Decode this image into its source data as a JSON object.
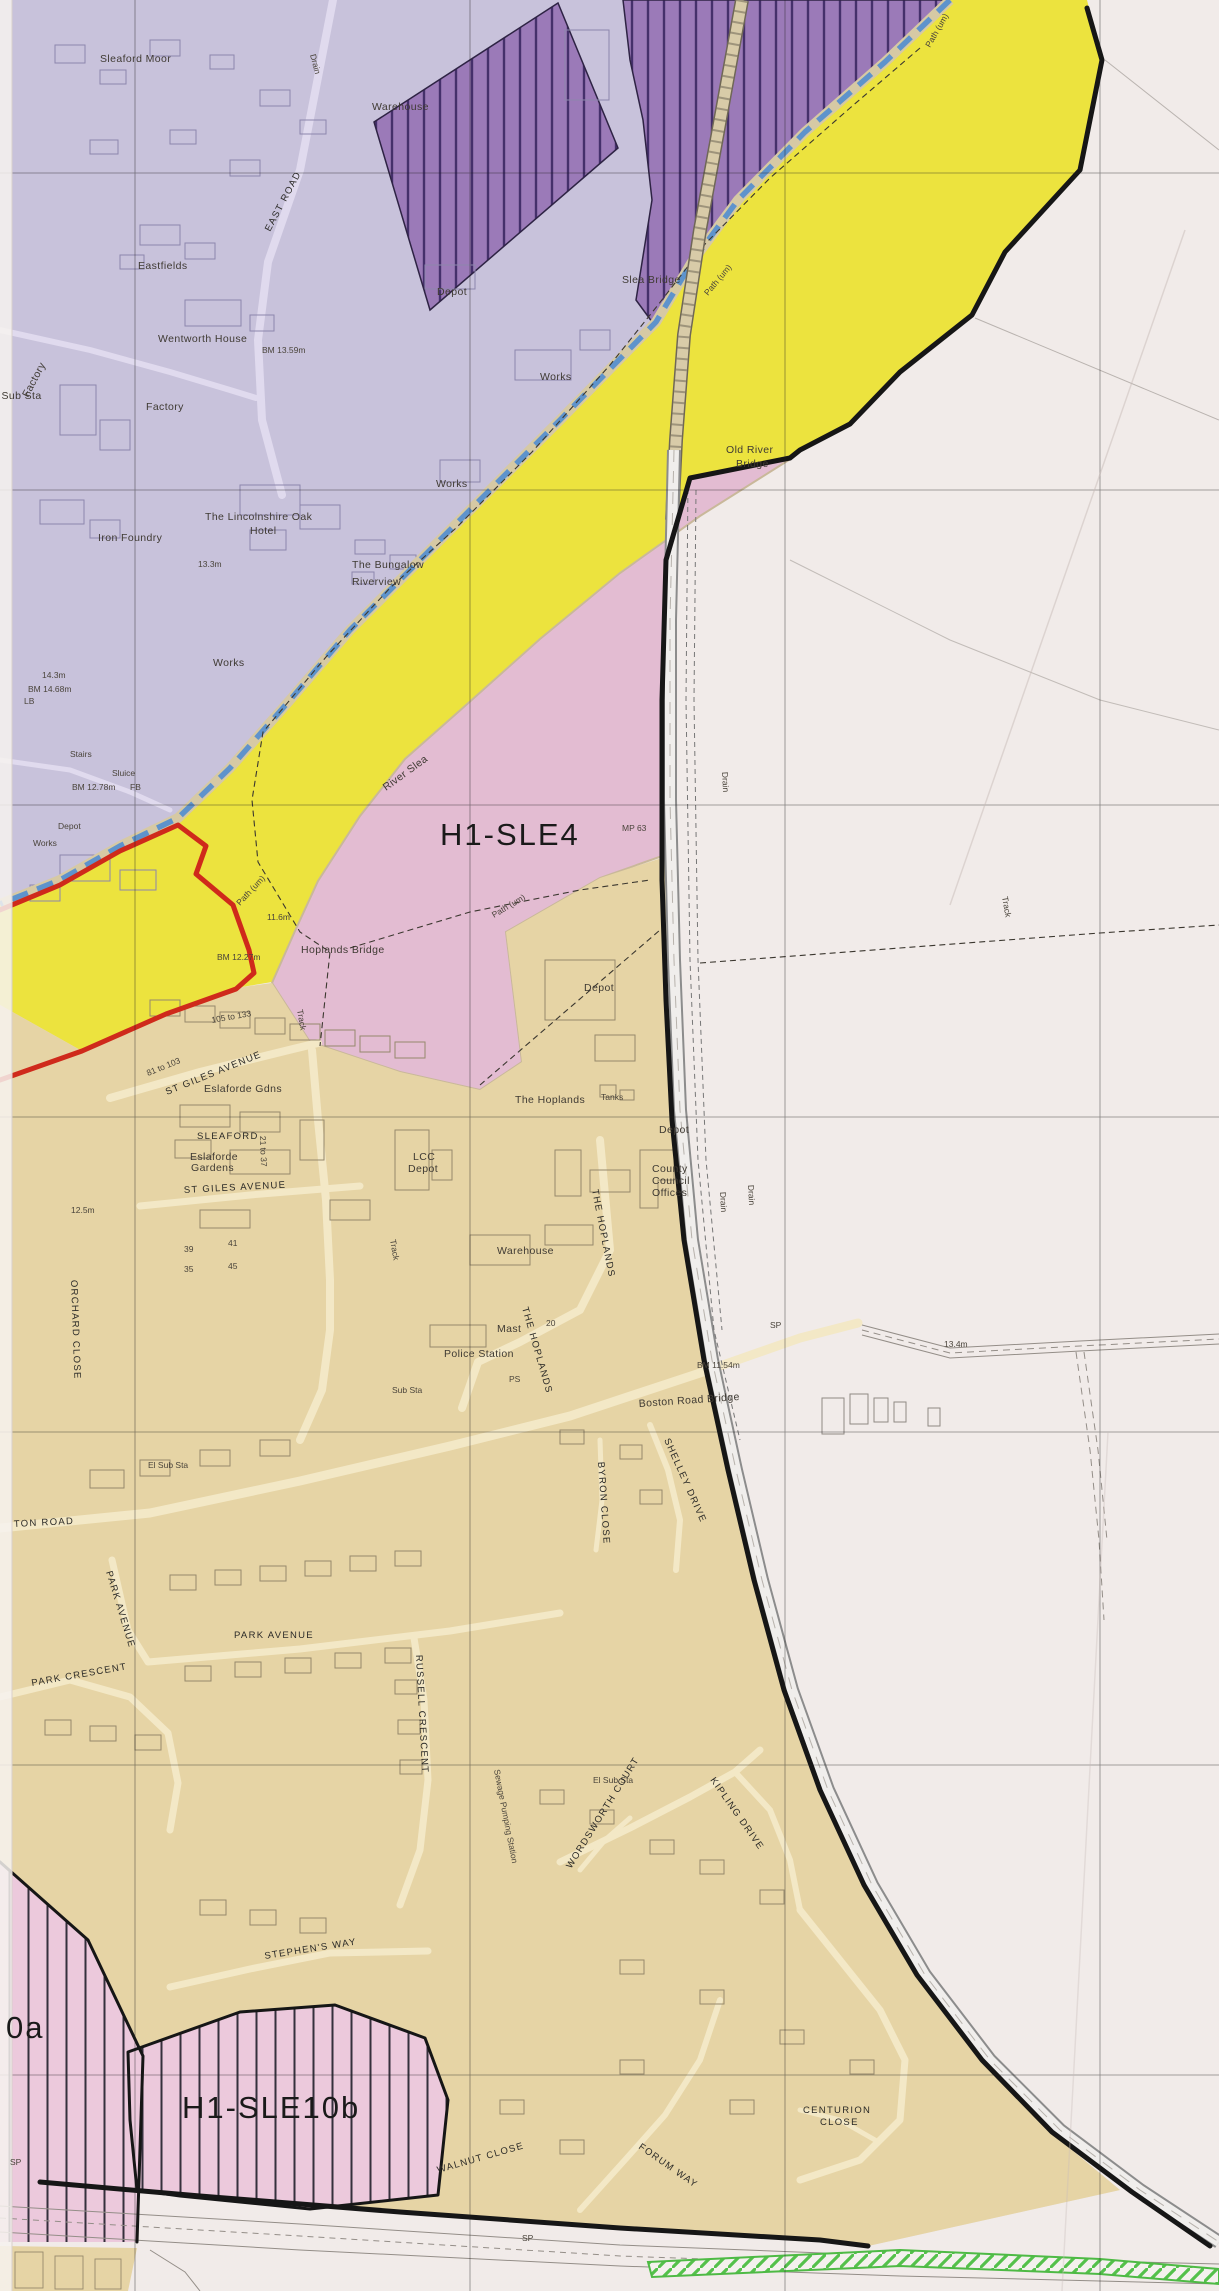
{
  "map": {
    "title": "Local plan proposals map extract (scanned)",
    "zones": [
      {
        "code": "H1-SLE4",
        "fill": "#e3bcd2",
        "style": "solid pink housing allocation"
      },
      {
        "code": "H1-SLE10b",
        "fill": "#ecc9dc",
        "style": "pink vertical-hatched housing allocation"
      },
      {
        "code": "0a",
        "fill": "#ecc9dc",
        "style": "pink vertical-hatched allocation clipped at map edge"
      }
    ],
    "colors": {
      "paper": "#f1ebe9",
      "urban_lavender": "#c8c2db",
      "allocation_purple": "#9b7ab8",
      "purple_hatch_line": "#45306b",
      "river_corridor_yellow": "#ece33e",
      "housing_pink": "#e3bcd2",
      "hatched_pink": "#ecc9dc",
      "residential_beige": "#e6d4a5",
      "river_blue": "#5e93cc",
      "boundary_black": "#161616",
      "boundary_red": "#cf2a1b",
      "railway_buff": "#d8cba8",
      "green_hatch": "#4eba45"
    },
    "labels": [
      {
        "t": "H1-SLE4",
        "x": 440,
        "y": 845,
        "c": "zone"
      },
      {
        "t": "H1-SLE10b",
        "x": 182,
        "y": 2118,
        "c": "zone"
      },
      {
        "t": "0a",
        "x": 6,
        "y": 2038,
        "c": "zone"
      },
      {
        "t": "Sleaford Moor",
        "x": 100,
        "y": 62,
        "c": "place"
      },
      {
        "t": "Warehouse",
        "x": 372,
        "y": 110,
        "c": "place"
      },
      {
        "t": "Eastfields",
        "x": 138,
        "y": 269,
        "c": "place"
      },
      {
        "t": "Wentworth House",
        "x": 158,
        "y": 342,
        "c": "place"
      },
      {
        "t": "Factory",
        "x": 28,
        "y": 398,
        "r": -62,
        "c": "place"
      },
      {
        "t": "Factory",
        "x": 146,
        "y": 410,
        "c": "place"
      },
      {
        "t": "El Sub Sta",
        "x": -12,
        "y": 399,
        "c": "place"
      },
      {
        "t": "Depot",
        "x": 437,
        "y": 295,
        "c": "place"
      },
      {
        "t": "BM 13.59m",
        "x": 262,
        "y": 353,
        "c": "small"
      },
      {
        "t": "Works",
        "x": 540,
        "y": 380,
        "c": "place"
      },
      {
        "t": "Works",
        "x": 436,
        "y": 487,
        "c": "place"
      },
      {
        "t": "Works",
        "x": 213,
        "y": 666,
        "c": "place"
      },
      {
        "t": "Stairs",
        "x": 70,
        "y": 757,
        "c": "small"
      },
      {
        "t": "Depot",
        "x": 58,
        "y": 829,
        "c": "small"
      },
      {
        "t": "Works",
        "x": 33,
        "y": 846,
        "c": "small"
      },
      {
        "t": "14.3m",
        "x": 42,
        "y": 678,
        "c": "small"
      },
      {
        "t": "BM 14.68m",
        "x": 28,
        "y": 692,
        "c": "small"
      },
      {
        "t": "LB",
        "x": 24,
        "y": 704,
        "c": "small"
      },
      {
        "t": "BM 12.78m",
        "x": 72,
        "y": 790,
        "c": "small"
      },
      {
        "t": "Sluice",
        "x": 112,
        "y": 776,
        "c": "small"
      },
      {
        "t": "FB",
        "x": 130,
        "y": 790,
        "c": "small"
      },
      {
        "t": "Iron Foundry",
        "x": 98,
        "y": 541,
        "c": "place"
      },
      {
        "t": "The Lincolnshire Oak",
        "x": 205,
        "y": 520,
        "c": "place"
      },
      {
        "t": "Hotel",
        "x": 250,
        "y": 534,
        "c": "place"
      },
      {
        "t": "13.3m",
        "x": 198,
        "y": 567,
        "c": "small"
      },
      {
        "t": "The Bungalow",
        "x": 352,
        "y": 568,
        "c": "place"
      },
      {
        "t": "Riverview",
        "x": 352,
        "y": 585,
        "c": "place"
      },
      {
        "t": "Slea Bridge",
        "x": 622,
        "y": 283,
        "c": "place"
      },
      {
        "t": "Old River",
        "x": 726,
        "y": 453,
        "c": "place"
      },
      {
        "t": "Bridge",
        "x": 736,
        "y": 467,
        "c": "place"
      },
      {
        "t": "River Slea",
        "x": 386,
        "y": 791,
        "r": -36,
        "c": "place"
      },
      {
        "t": "EAST ROAD",
        "x": 270,
        "y": 232,
        "r": -62,
        "c": "street"
      },
      {
        "t": "Drain",
        "x": 310,
        "y": 55,
        "r": 75,
        "c": "small"
      },
      {
        "t": "Path (um)",
        "x": 930,
        "y": 48,
        "r": -60,
        "c": "small"
      },
      {
        "t": "Path (um)",
        "x": 708,
        "y": 296,
        "r": -50,
        "c": "small"
      },
      {
        "t": "Path (um)",
        "x": 240,
        "y": 906,
        "r": -47,
        "c": "small"
      },
      {
        "t": "Path (um)",
        "x": 494,
        "y": 918,
        "r": -31,
        "c": "small"
      },
      {
        "t": "MP 63",
        "x": 622,
        "y": 831,
        "c": "small"
      },
      {
        "t": "Drain",
        "x": 722,
        "y": 772,
        "r": 87,
        "c": "small"
      },
      {
        "t": "11.6m",
        "x": 267,
        "y": 920,
        "c": "small"
      },
      {
        "t": "BM 12.27m",
        "x": 217,
        "y": 960,
        "c": "small"
      },
      {
        "t": "Hoplands Bridge",
        "x": 301,
        "y": 953,
        "c": "place"
      },
      {
        "t": "105 to 133",
        "x": 212,
        "y": 1023,
        "r": -10,
        "c": "small"
      },
      {
        "t": "Track",
        "x": 297,
        "y": 1010,
        "r": 80,
        "c": "small"
      },
      {
        "t": "Track",
        "x": 390,
        "y": 1240,
        "r": 80,
        "c": "small"
      },
      {
        "t": "Track",
        "x": 1002,
        "y": 897,
        "r": 80,
        "c": "small"
      },
      {
        "t": "Depot",
        "x": 584,
        "y": 991,
        "c": "place"
      },
      {
        "t": "The Hoplands",
        "x": 515,
        "y": 1103,
        "c": "place"
      },
      {
        "t": "Tanks",
        "x": 601,
        "y": 1100,
        "c": "small"
      },
      {
        "t": "Depot",
        "x": 659,
        "y": 1133,
        "c": "place"
      },
      {
        "t": "County",
        "x": 652,
        "y": 1172,
        "c": "place"
      },
      {
        "t": "Council",
        "x": 652,
        "y": 1184,
        "c": "place"
      },
      {
        "t": "Offices",
        "x": 652,
        "y": 1196,
        "c": "place"
      },
      {
        "t": "Warehouse",
        "x": 497,
        "y": 1254,
        "c": "place"
      },
      {
        "t": "Drain",
        "x": 720,
        "y": 1192,
        "r": 87,
        "c": "small"
      },
      {
        "t": "Drain",
        "x": 748,
        "y": 1185,
        "r": 87,
        "c": "small"
      },
      {
        "t": "LCC",
        "x": 413,
        "y": 1160,
        "c": "place"
      },
      {
        "t": "Depot",
        "x": 408,
        "y": 1172,
        "c": "place"
      },
      {
        "t": "ST GILES AVENUE",
        "x": 167,
        "y": 1095,
        "r": -22,
        "c": "street"
      },
      {
        "t": "Eslaforde Gdns",
        "x": 204,
        "y": 1092,
        "c": "place"
      },
      {
        "t": "SLEAFORD",
        "x": 197,
        "y": 1139,
        "ls": 4,
        "c": "street"
      },
      {
        "t": "Eslaforde",
        "x": 190,
        "y": 1160,
        "c": "place"
      },
      {
        "t": "Gardens",
        "x": 191,
        "y": 1171,
        "c": "place"
      },
      {
        "t": "ST GILES AVENUE",
        "x": 184,
        "y": 1193,
        "r": -3,
        "c": "street"
      },
      {
        "t": "12.5m",
        "x": 71,
        "y": 1213,
        "c": "small"
      },
      {
        "t": "81 to 103",
        "x": 148,
        "y": 1076,
        "r": -22,
        "c": "small"
      },
      {
        "t": "21 to 37",
        "x": 260,
        "y": 1136,
        "r": 88,
        "c": "small"
      },
      {
        "t": "39",
        "x": 184,
        "y": 1252,
        "c": "small"
      },
      {
        "t": "35",
        "x": 184,
        "y": 1272,
        "c": "small"
      },
      {
        "t": "41",
        "x": 228,
        "y": 1246,
        "c": "small"
      },
      {
        "t": "45",
        "x": 228,
        "y": 1269,
        "c": "small"
      },
      {
        "t": "20",
        "x": 546,
        "y": 1326,
        "c": "small"
      },
      {
        "t": "ORCHARD CLOSE",
        "x": 71,
        "y": 1280,
        "r": 88,
        "c": "street"
      },
      {
        "t": "THE HOPLANDS",
        "x": 592,
        "y": 1190,
        "r": 79,
        "c": "street"
      },
      {
        "t": "THE HOPLANDS",
        "x": 522,
        "y": 1308,
        "r": 74,
        "c": "street"
      },
      {
        "t": "Police Station",
        "x": 444,
        "y": 1357,
        "c": "place"
      },
      {
        "t": "Mast",
        "x": 497,
        "y": 1332,
        "c": "place"
      },
      {
        "t": "PS",
        "x": 509,
        "y": 1382,
        "c": "small"
      },
      {
        "t": "Sub Sta",
        "x": 392,
        "y": 1393,
        "c": "small"
      },
      {
        "t": "Boston Road Bridge",
        "x": 639,
        "y": 1407,
        "r": -4,
        "c": "place"
      },
      {
        "t": "BM 11.54m",
        "x": 697,
        "y": 1368,
        "c": "small"
      },
      {
        "t": "SP",
        "x": 770,
        "y": 1328,
        "c": "small"
      },
      {
        "t": "SP",
        "x": 522,
        "y": 2241,
        "c": "small"
      },
      {
        "t": "SP",
        "x": 10,
        "y": 2165,
        "c": "small"
      },
      {
        "t": "13.4m",
        "x": 944,
        "y": 1347,
        "c": "small"
      },
      {
        "t": "SHELLEY DRIVE",
        "x": 664,
        "y": 1440,
        "r": 66,
        "c": "street"
      },
      {
        "t": "BYRON CLOSE",
        "x": 598,
        "y": 1462,
        "r": 86,
        "c": "street"
      },
      {
        "t": "TON ROAD",
        "x": 14,
        "y": 1527,
        "r": -3,
        "c": "street"
      },
      {
        "t": "El Sub Sta",
        "x": 148,
        "y": 1468,
        "c": "small"
      },
      {
        "t": "PARK AVENUE",
        "x": 106,
        "y": 1572,
        "r": 73,
        "c": "street"
      },
      {
        "t": "PARK AVENUE",
        "x": 234,
        "y": 1638,
        "c": "street"
      },
      {
        "t": "PARK CRESCENT",
        "x": 32,
        "y": 1686,
        "r": -10,
        "c": "street"
      },
      {
        "t": "RUSSELL CRESCENT",
        "x": 416,
        "y": 1655,
        "r": 87,
        "c": "street"
      },
      {
        "t": "El Sub Sta",
        "x": 593,
        "y": 1783,
        "c": "small"
      },
      {
        "t": "Sewage Pumping Station",
        "x": 494,
        "y": 1770,
        "r": 79,
        "c": "small"
      },
      {
        "t": "WORDSWORTH COURT",
        "x": 571,
        "y": 1869,
        "r": -58,
        "c": "street"
      },
      {
        "t": "KIPLING DRIVE",
        "x": 710,
        "y": 1780,
        "r": 55,
        "c": "street"
      },
      {
        "t": "STEPHEN'S WAY",
        "x": 265,
        "y": 1959,
        "r": -9,
        "c": "street"
      },
      {
        "t": "CENTURION",
        "x": 803,
        "y": 2113,
        "c": "street"
      },
      {
        "t": "CLOSE",
        "x": 820,
        "y": 2125,
        "c": "street"
      },
      {
        "t": "FORUM WAY",
        "x": 638,
        "y": 2148,
        "r": 35,
        "c": "street"
      },
      {
        "t": "WALNUT CLOSE",
        "x": 438,
        "y": 2173,
        "r": -16,
        "c": "street"
      }
    ]
  }
}
